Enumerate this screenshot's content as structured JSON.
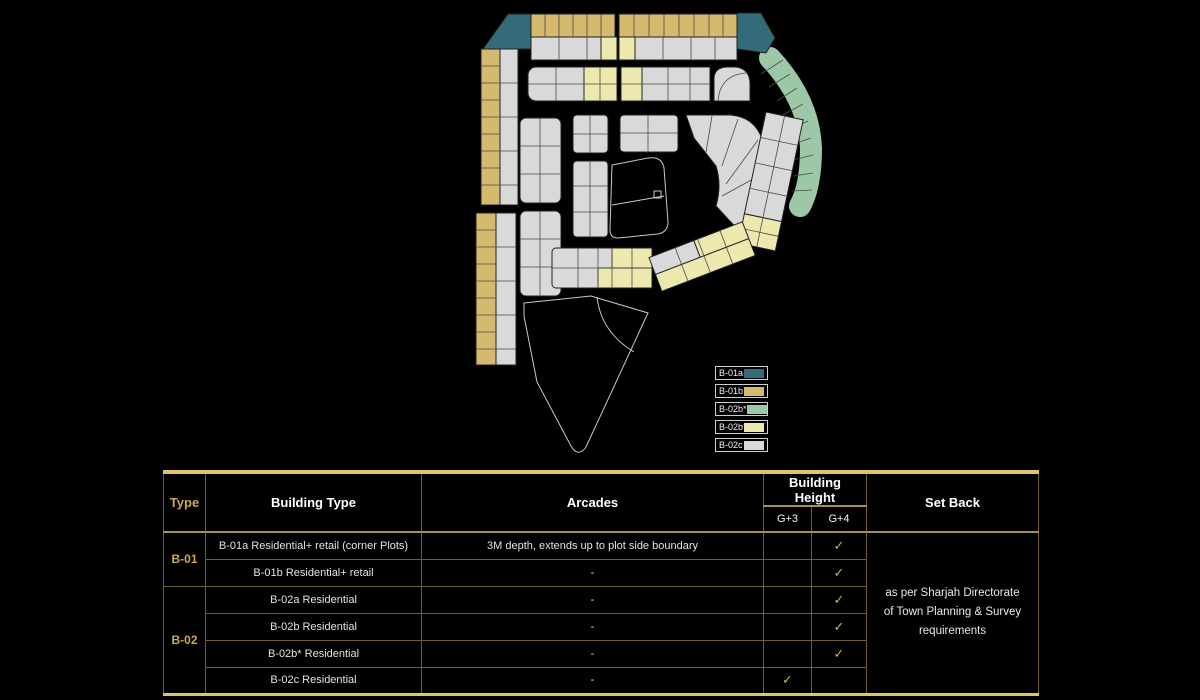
{
  "colors": {
    "teal": "#336b78",
    "gold": "#d5b96e",
    "sage": "#9dc8a7",
    "paleYellow": "#ede8ad",
    "gray": "#d9d9d9",
    "accent": "#c8a851",
    "check": "#c9b45a"
  },
  "legend": {
    "items": [
      {
        "label": "B-01a",
        "color_key": "teal"
      },
      {
        "label": "B-01b",
        "color_key": "gold"
      },
      {
        "label": "B-02b*",
        "color_key": "sage"
      },
      {
        "label": "B-02b",
        "color_key": "paleYellow"
      },
      {
        "label": "B-02c",
        "color_key": "gray"
      }
    ]
  },
  "table": {
    "headers": {
      "type": "Type",
      "building_type": "Building Type",
      "arcades": "Arcades",
      "building_height": "Building Height",
      "g3": "G+3",
      "g4": "G+4",
      "set_back": "Set Back"
    },
    "groups": [
      {
        "label": "B-01"
      },
      {
        "label": "B-02"
      }
    ],
    "rows": [
      {
        "building_type": "B-01a Residential+ retail (corner Plots)",
        "arcades": "3M depth, extends up to plot side boundary",
        "g3": "",
        "g4": "✓"
      },
      {
        "building_type": "B-01b Residential+ retail",
        "arcades": "-",
        "g3": "",
        "g4": "✓"
      },
      {
        "building_type": "B-02a Residential",
        "arcades": "-",
        "g3": "",
        "g4": "✓"
      },
      {
        "building_type": "B-02b Residential",
        "arcades": "-",
        "g3": "",
        "g4": "✓"
      },
      {
        "building_type": "B-02b* Residential",
        "arcades": "-",
        "g3": "",
        "g4": "✓"
      },
      {
        "building_type": "B-02c Residential",
        "arcades": "-",
        "g3": "✓",
        "g4": ""
      }
    ],
    "set_back_note": "as per Sharjah Directorate of Town Planning & Survey requirements"
  }
}
